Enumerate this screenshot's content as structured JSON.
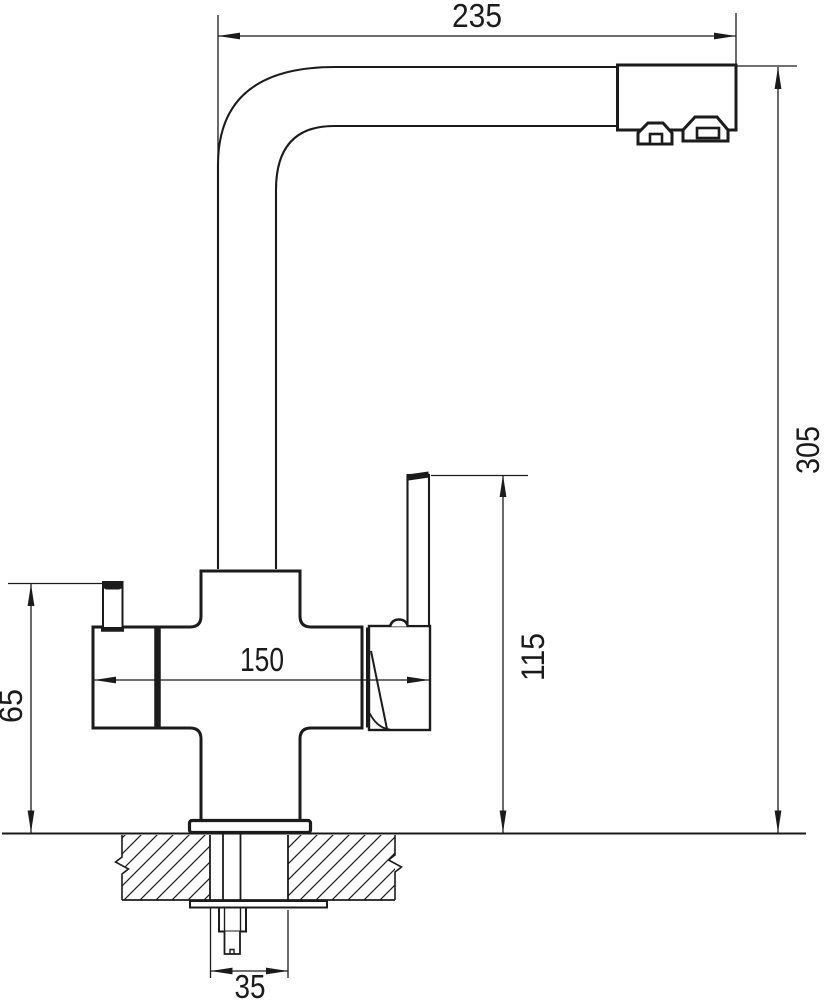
{
  "drawing": {
    "subject": "kitchen-faucet-side-elevation",
    "background": "#ffffff",
    "line_color": "#1b1b1b",
    "dimensions": {
      "spout_reach": "235",
      "overall_height": "305",
      "body_width": "150",
      "lever_top_height": "115",
      "side_handle_height": "65",
      "mounting_hole_diameter": "35"
    }
  }
}
